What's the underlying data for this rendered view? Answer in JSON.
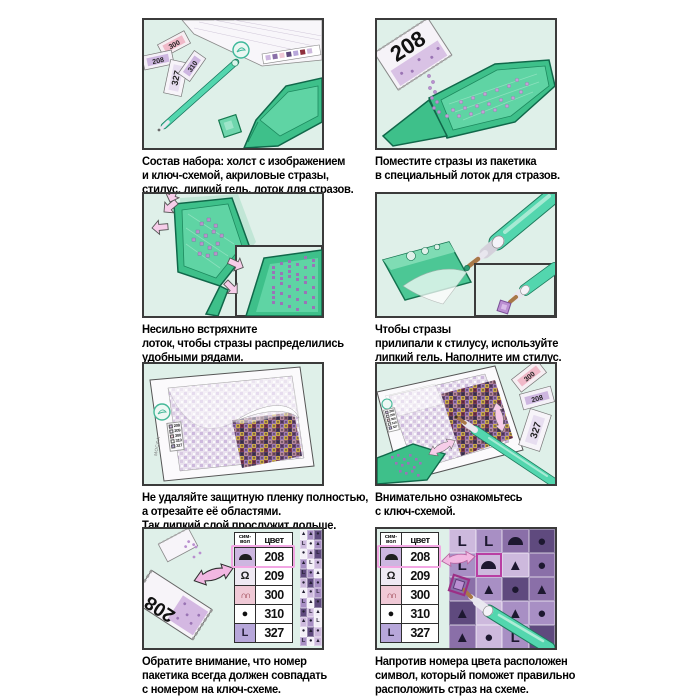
{
  "colors": {
    "panel_bg": "#dff0e9",
    "panel_border": "#3b3b3b",
    "tray_green": "#3ec08a",
    "tray_green_dark": "#10684a",
    "tray_green_light": "#5fd4a4",
    "pen_teal": "#53d6ae",
    "stone_purple": "#b58cc9",
    "arrow_pink": "#f5c7e6",
    "highlight_pink": "#f2a6e3",
    "grid_highlight": "#b93fa3"
  },
  "captions": {
    "p1": "Состав набора: холст с изображением\nи ключ-схемой, акриловые стразы,\nстилус, липкий гель, лоток для стразов.",
    "p2": "Поместите стразы из пакетика\nв специальный лоток для стразов.",
    "p3": "Несильно встряхните\nлоток, чтобы стразы распределились\nудобными рядами.",
    "p4": "Чтобы стразы\nприлипали к стилусу, используйте\nлипкий гель. Наполните им стилус.",
    "p5": "Не удаляйте защитную пленку полностью,\nа отрезайте её областями.\nТак липкий слой прослужит дольше.",
    "p6": "Внимательно ознакомьтесь\nс ключ-схемой.",
    "p7": "Обратите внимание, что номер\nпакетика всегда должен совпадать\nс номером на ключ-схеме.",
    "p8": "Напротив номера цвета расположен\nсимвол, который поможет правильно\nрасположить страз на схеме."
  },
  "labels": {
    "packet_number": "208",
    "brand": "МОСФА"
  },
  "kit_packets": [
    "300",
    "208",
    "327",
    "310"
  ],
  "panel6_packets": [
    "300",
    "208",
    "327"
  ],
  "key_table": {
    "header_symbol": "сим-\nвол",
    "header_color": "цвет",
    "rows": [
      {
        "color_num": "208",
        "glyph": "h",
        "cell_bg": "#cdb6e0",
        "glyph_color": "#1f1f1f",
        "highlight": true
      },
      {
        "color_num": "209",
        "glyph": "hook",
        "cell_bg": "#efe9f3",
        "glyph_color": "#1f1f1f",
        "highlight": false
      },
      {
        "color_num": "300",
        "glyph": "arch",
        "cell_bg": "#f0c9d6",
        "glyph_color": "#8e2f3c",
        "highlight": false
      },
      {
        "color_num": "310",
        "glyph": "o",
        "cell_bg": "#ffffff",
        "glyph_color": "#111111",
        "highlight": false
      },
      {
        "color_num": "327",
        "glyph": "L",
        "cell_bg": "#b7a7da",
        "glyph_color": "#26203a",
        "highlight": false
      }
    ]
  },
  "pattern_palette": {
    "w": "#f3eff7",
    "a": "#cdb9dd",
    "b": "#a88fc4",
    "c": "#8a6fa8",
    "d": "#5f4a7e"
  },
  "strip_pattern": {
    "cells": [
      [
        "t:w",
        "t:b",
        "o:d"
      ],
      [
        "L:a",
        "o:w",
        "t:b"
      ],
      [
        "o:w",
        "t:a",
        "L:d"
      ],
      [
        "t:b",
        "L:w",
        "o:a"
      ],
      [
        "L:d",
        "o:b",
        "t:w"
      ],
      [
        "o:a",
        "t:d",
        "o:b"
      ],
      [
        "t:w",
        "o:a",
        "L:b"
      ],
      [
        "L:b",
        "t:w",
        "o:d"
      ],
      [
        "o:d",
        "L:a",
        "t:w"
      ],
      [
        "t:a",
        "o:b",
        "L:w"
      ],
      [
        "o:w",
        "t:d",
        "o:a"
      ],
      [
        "L:b",
        "o:w",
        "t:a"
      ]
    ]
  },
  "big_grid": {
    "cells": [
      [
        "L:a",
        "L:b",
        "h:c",
        "o:d"
      ],
      [
        "L:b",
        "h:a",
        "t:a",
        "o:c"
      ],
      [
        ".:c",
        "t:b",
        "o:d",
        "t:c"
      ],
      [
        "t:d",
        ".:a",
        "t:b",
        "o:b"
      ],
      [
        "t:c",
        "o:a",
        "L:b",
        ".:d"
      ]
    ],
    "highlight": [
      1,
      1
    ],
    "glyph_color": "#1d1830"
  }
}
